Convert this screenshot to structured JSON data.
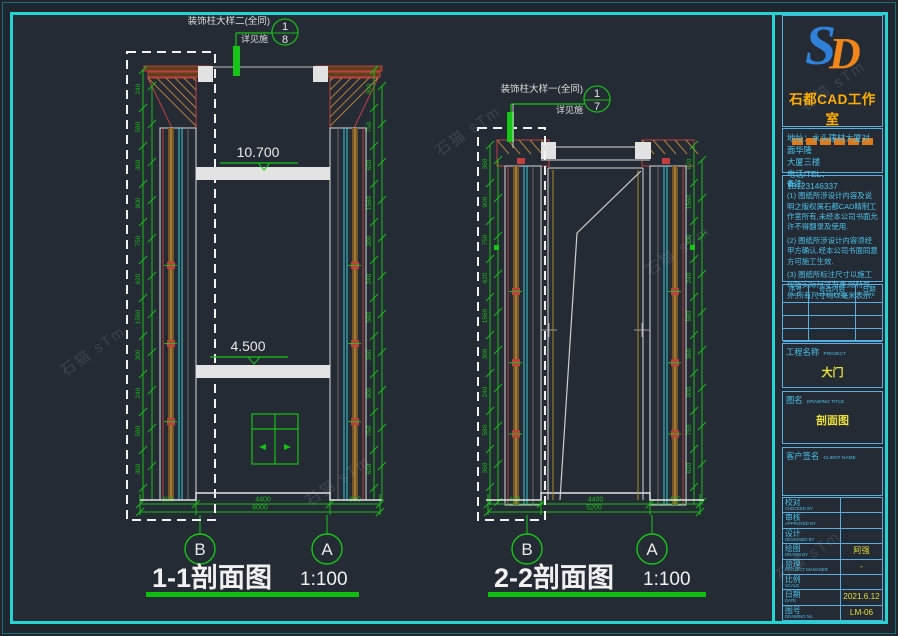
{
  "drawing": {
    "callout1": {
      "label": "装饰柱大样二(全同)",
      "sub": "详见施",
      "num": "1",
      "den": "8"
    },
    "callout2": {
      "label": "装饰柱大样一(全同)",
      "sub": "详见施",
      "num": "1",
      "den": "7"
    },
    "levels": {
      "upper": "10.700",
      "lower": "4.500"
    },
    "section1": {
      "title": "1-1剖面图",
      "scale": "1:100",
      "grid_left": "B",
      "grid_right": "A",
      "dims": [
        "800",
        "4400",
        "800"
      ],
      "total": "6000"
    },
    "section2": {
      "title": "2-2剖面图",
      "scale": "1:100",
      "grid_left": "B",
      "grid_right": "A",
      "dims": [
        "400",
        "4400",
        "400"
      ],
      "total": "5200"
    },
    "side_dims": [
      "240",
      "580",
      "360",
      "900",
      "750",
      "620",
      "1560",
      "300"
    ]
  },
  "title_block": {
    "logo": {
      "s": "S",
      "d": "D"
    },
    "studio_name": "石都CAD工作室",
    "address_line1": "地址：水头建材大厦对面华隆",
    "address_line2": "大厦三楼",
    "phone": "电话/TEL：13123146337",
    "notes_title": "备注:",
    "note1": "(1) 图纸所涉设计内容及说明之版权属石都CAD精制工作室所有,未经本公司书面允许不得翻录及使用.",
    "note2": "(2) 图纸所涉设计内容须经甲方确认,经本公司书面同意方可施工生效.",
    "note3": "(3) 图纸所标注尺寸以施工现场实际尺寸为准,除特殊外,所有尺寸均以毫米表示.",
    "rev": {
      "h1_zh": "序号",
      "h1_en": "NO.",
      "h2_zh": "修改内容",
      "h2_en": "DESCRIPTION",
      "h3_zh": "日期",
      "h3_en": "DATE"
    },
    "project": {
      "zh": "工程名称",
      "en": "PROJECT",
      "value": "大门"
    },
    "drawing_title": {
      "zh": "图名",
      "en": "DRAWING TITLE",
      "value": "剖面图"
    },
    "client": {
      "zh": "客户签名",
      "en": "CLIENT NAME"
    },
    "rows": [
      {
        "zh": "校对",
        "en": "CHECKED BY",
        "value": ""
      },
      {
        "zh": "审核",
        "en": "APPROVED BY",
        "value": ""
      },
      {
        "zh": "设计",
        "en": "DESIGNED BY",
        "value": ""
      },
      {
        "zh": "绘图",
        "en": "DRAWN BY",
        "value": "阿强"
      },
      {
        "zh": "监理",
        "en": "PROJECT MANAGER",
        "value": "-"
      },
      {
        "zh": "比例",
        "en": "SCALE",
        "value": ""
      },
      {
        "zh": "日期",
        "en": "DATE",
        "value": "2021.6.12"
      },
      {
        "zh": "图号",
        "en": "DRAWING No.",
        "value": "LM-06"
      }
    ]
  },
  "watermark_text": "石猫 sTm"
}
